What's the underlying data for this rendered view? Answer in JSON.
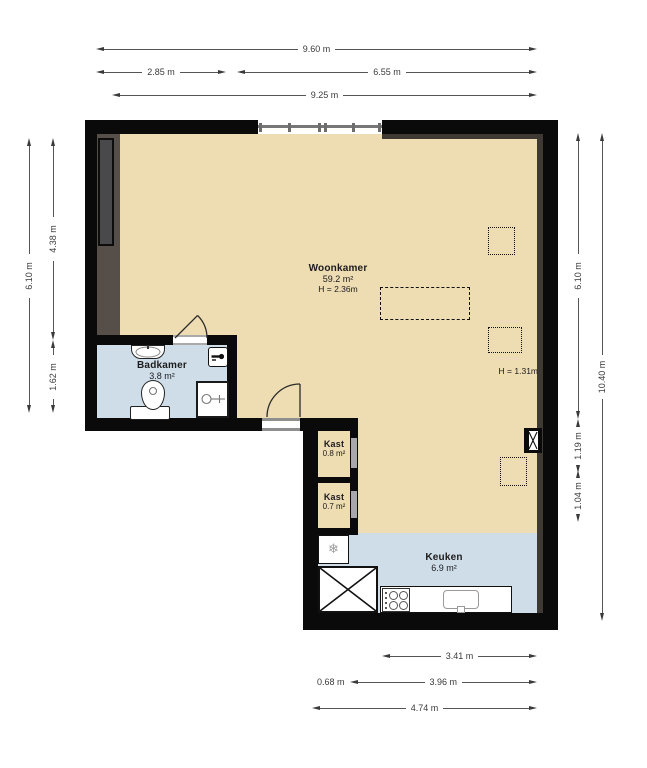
{
  "rooms": {
    "woonkamer": {
      "name": "Woonkamer",
      "area": "59.2 m²",
      "ceiling_height": "H = 2.36m"
    },
    "badkamer": {
      "name": "Badkamer",
      "area": "3.8 m²"
    },
    "kast_boven": {
      "name": "Kast",
      "area": "0.8 m²"
    },
    "kast_onder": {
      "name": "Kast",
      "area": "0.7 m²"
    },
    "keuken": {
      "name": "Keuken",
      "area": "6.9 m²"
    }
  },
  "annotations": {
    "low_ceiling": "H = 1.31m"
  },
  "dimensions": {
    "top_total": "9.60 m",
    "top_left": "2.85 m",
    "top_right": "6.55 m",
    "top_inner": "9.25 m",
    "left_total": "6.10 m",
    "left_upper": "4.38 m",
    "left_lower": "1.62 m",
    "right_upper": "6.10 m",
    "right_mid": "1.19 m",
    "right_lower": "1.04 m",
    "right_total": "10.40 m",
    "bottom_inner": "3.41 m",
    "bottom_small": "0.68 m",
    "bottom_mid": "3.96 m",
    "bottom_total": "4.74 m"
  },
  "icons": {
    "fridge": "❄"
  },
  "colors": {
    "wall": "#0a0a0a",
    "wall_shadow": "#3f3933",
    "floor_living": "#eedcb3",
    "floor_wet": "#cfdde9",
    "niche": "#564f49",
    "niche_box": "#49494b"
  }
}
